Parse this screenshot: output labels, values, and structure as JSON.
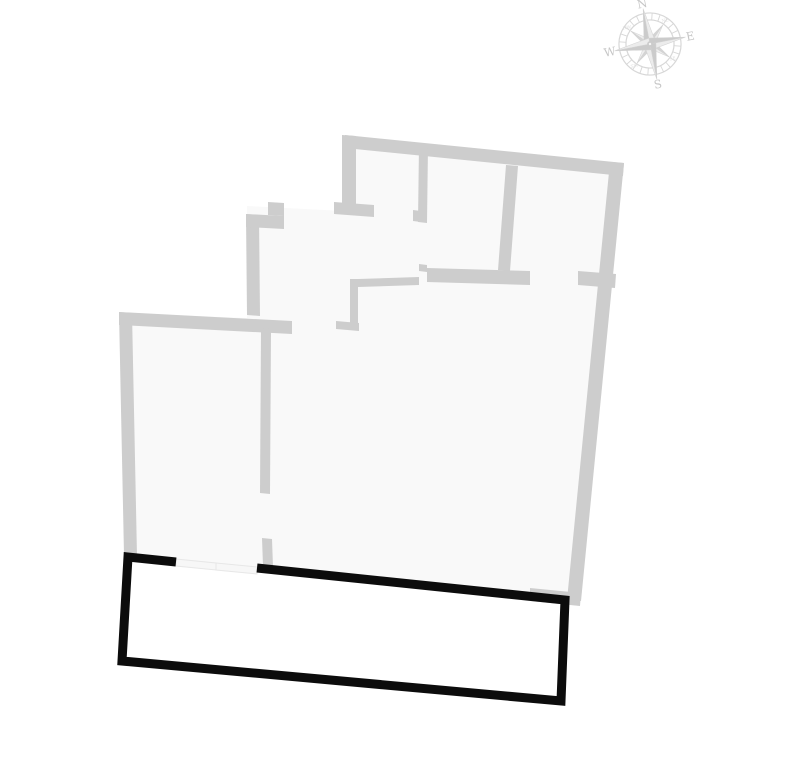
{
  "page": {
    "background": "#ffffff",
    "width": 787,
    "height": 781
  },
  "colors": {
    "wall": "#cdcdcd",
    "floor": "#f9f9f9",
    "balcony_outline": "#0c0c0c",
    "window_fill": "#f7f7f7",
    "window_stroke": "#e7e7e7",
    "compass_ring": "#d7d7d7",
    "compass_dark": "#cbcbcb",
    "compass_light": "#ececec",
    "compass_edge": "#d2d2d2",
    "compass_text": "#c6c6c6",
    "compass_smalltext": "#dedede"
  },
  "floor_plan": {
    "floor_outline": [
      [
        344,
        136
      ],
      [
        623,
        164
      ],
      [
        581,
        600
      ],
      [
        128,
        557
      ],
      [
        121,
        313
      ],
      [
        247,
        318
      ],
      [
        247,
        206
      ],
      [
        344,
        211
      ]
    ],
    "walls": [
      [
        [
          345,
          135
        ],
        [
          624,
          163
        ],
        [
          623,
          176
        ],
        [
          345,
          148
        ]
      ],
      [
        [
          610,
          162
        ],
        [
          624,
          163
        ],
        [
          581,
          601
        ],
        [
          567,
          600
        ]
      ],
      [
        [
          342,
          135
        ],
        [
          356,
          136
        ],
        [
          356,
          204
        ],
        [
          342,
          203
        ]
      ],
      [
        [
          334,
          202
        ],
        [
          374,
          205
        ],
        [
          374,
          217
        ],
        [
          334,
          214
        ]
      ],
      [
        [
          419,
          145
        ],
        [
          428,
          146
        ],
        [
          427,
          223
        ],
        [
          418,
          222
        ]
      ],
      [
        [
          413,
          210
        ],
        [
          421,
          211
        ],
        [
          421,
          222
        ],
        [
          413,
          221
        ]
      ],
      [
        [
          506,
          165
        ],
        [
          518,
          166
        ],
        [
          510,
          271
        ],
        [
          498,
          270
        ]
      ],
      [
        [
          358,
          279
        ],
        [
          419,
          277
        ],
        [
          419,
          285
        ],
        [
          358,
          287
        ]
      ],
      [
        [
          419,
          264
        ],
        [
          427,
          265
        ],
        [
          427,
          272
        ],
        [
          419,
          271
        ]
      ],
      [
        [
          427,
          268
        ],
        [
          530,
          271
        ],
        [
          530,
          285
        ],
        [
          427,
          282
        ]
      ],
      [
        [
          578,
          271
        ],
        [
          616,
          274
        ],
        [
          615,
          288
        ],
        [
          578,
          285
        ]
      ],
      [
        [
          350,
          279
        ],
        [
          358,
          279
        ],
        [
          358,
          326
        ],
        [
          350,
          325
        ]
      ],
      [
        [
          336,
          321
        ],
        [
          359,
          323
        ],
        [
          359,
          331
        ],
        [
          336,
          329
        ]
      ],
      [
        [
          246,
          214
        ],
        [
          259,
          215
        ],
        [
          260,
          316
        ],
        [
          247,
          315
        ]
      ],
      [
        [
          246,
          214
        ],
        [
          284,
          216
        ],
        [
          284,
          229
        ],
        [
          246,
          227
        ]
      ],
      [
        [
          268,
          202
        ],
        [
          284,
          203
        ],
        [
          284,
          216
        ],
        [
          268,
          215
        ]
      ],
      [
        [
          119,
          312
        ],
        [
          292,
          321
        ],
        [
          292,
          334
        ],
        [
          119,
          325
        ]
      ],
      [
        [
          119,
          312
        ],
        [
          132,
          313
        ],
        [
          137,
          556
        ],
        [
          124,
          555
        ]
      ],
      [
        [
          261,
          328
        ],
        [
          271,
          329
        ],
        [
          270,
          494
        ],
        [
          260,
          493
        ]
      ],
      [
        [
          262,
          538
        ],
        [
          272,
          539
        ],
        [
          273,
          567
        ],
        [
          263,
          566
        ]
      ],
      [
        [
          530,
          588
        ],
        [
          581,
          593
        ],
        [
          580,
          606
        ],
        [
          530,
          601
        ]
      ]
    ],
    "windows": [
      [
        [
          176,
          559
        ],
        [
          216,
          563
        ],
        [
          216,
          570
        ],
        [
          176,
          566
        ]
      ],
      [
        [
          216,
          563
        ],
        [
          257,
          567
        ],
        [
          257,
          574
        ],
        [
          216,
          570
        ]
      ]
    ],
    "balcony": {
      "path_points": [
        [
          257,
          568
        ],
        [
          565,
          600
        ],
        [
          561,
          701
        ],
        [
          122,
          661
        ],
        [
          128,
          557
        ],
        [
          176,
          562
        ]
      ],
      "stroke_width": 9
    }
  },
  "compass": {
    "cx": 650,
    "cy": 44,
    "rotation": -11,
    "outer_r": 31,
    "inner_r": 24,
    "cardinal_tip_r": 36,
    "cardinal_w": 6,
    "intercardinal_tip_r": 23,
    "intercardinal_w": 4.5,
    "label_r": 41,
    "small_label_r": 27.5,
    "cardinal": [
      {
        "angle": 0,
        "label": "N"
      },
      {
        "angle": 90,
        "label": "E"
      },
      {
        "angle": 180,
        "label": "S"
      },
      {
        "angle": 270,
        "label": "W"
      }
    ],
    "intercardinal": [
      {
        "angle": 45,
        "label": "NE"
      },
      {
        "angle": 135,
        "label": "SE"
      },
      {
        "angle": 225,
        "label": "SW"
      },
      {
        "angle": 315,
        "label": "NW"
      }
    ]
  }
}
